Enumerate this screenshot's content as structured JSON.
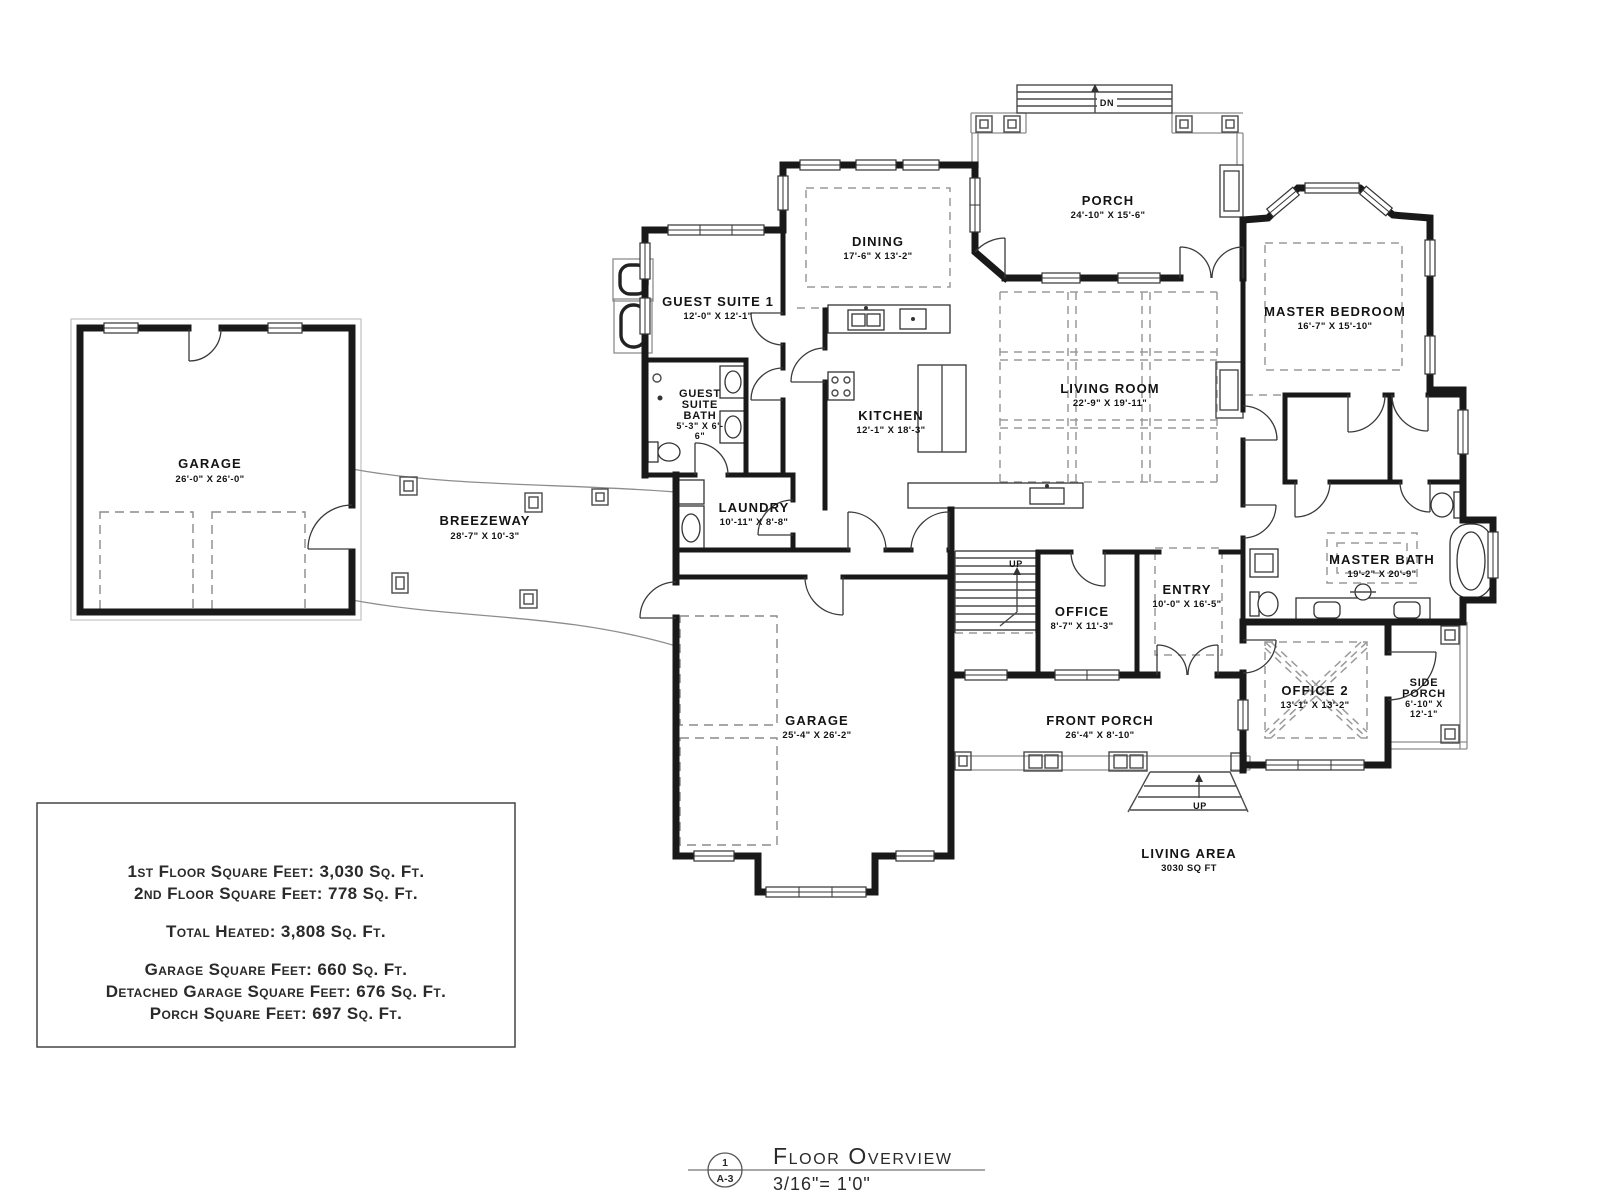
{
  "rooms": {
    "detached_garage": {
      "name": "GARAGE",
      "dims": "26'-0\" X 26'-0\""
    },
    "breezeway": {
      "name": "BREEZEWAY",
      "dims": "28'-7\" X 10'-3\""
    },
    "guest_suite_1": {
      "name": "GUEST SUITE 1",
      "dims": "12'-0\" X 12'-1\""
    },
    "guest_suite_bath": {
      "lines": [
        "GUEST",
        "SUITE",
        "BATH",
        "5'-3\" X 6'-",
        "6\""
      ]
    },
    "dining": {
      "name": "DINING",
      "dims": "17'-6\" X 13'-2\""
    },
    "rear_porch": {
      "name": "PORCH",
      "dims": "24'-10\" X 15'-6\""
    },
    "master_bedroom": {
      "name": "MASTER BEDROOM",
      "dims": "16'-7\" X 15'-10\""
    },
    "living_room": {
      "name": "LIVING ROOM",
      "dims": "22'-9\" X 19'-11\""
    },
    "kitchen": {
      "name": "KITCHEN",
      "dims": "12'-1\" X 18'-3\""
    },
    "laundry": {
      "name": "LAUNDRY",
      "dims": "10'-11\" X 8'-8\""
    },
    "master_bath": {
      "name": "MASTER BATH",
      "dims": "19'-2\" X 20'-9\""
    },
    "office": {
      "name": "OFFICE",
      "dims": "8'-7\" X 11'-3\""
    },
    "entry": {
      "name": "ENTRY",
      "dims": "10'-0\" X 16'-5\""
    },
    "office_2": {
      "name": "OFFICE 2",
      "dims": "13'-1\" X 13'-2\""
    },
    "side_porch": {
      "lines": [
        "SIDE",
        "PORCH",
        "6'-10\" X",
        "12'-1\""
      ]
    },
    "garage": {
      "name": "GARAGE",
      "dims": "25'-4\" X 26'-2\""
    },
    "front_porch": {
      "name": "FRONT PORCH",
      "dims": "26'-4\" X 8'-10\""
    }
  },
  "annotations": {
    "living_area_line1": "LIVING AREA",
    "living_area_line2": "3030 SQ FT",
    "stairs_up": "UP",
    "front_steps_up": "UP",
    "rear_steps_down": "DN"
  },
  "summary_box": {
    "line1": "1st Floor Square Feet: 3,030 Sq. Ft.",
    "line2": "2nd Floor Square Feet: 778 Sq. Ft.",
    "line3": "Total Heated: 3,808 Sq. Ft.",
    "line4": "Garage Square Feet: 660 Sq. Ft.",
    "line5": "Detached Garage Square Feet: 676 Sq. Ft.",
    "line6": "Porch Square Feet: 697 Sq. Ft."
  },
  "title_block": {
    "detail_number": "1",
    "sheet_number": "A-3",
    "title": "Floor Overview",
    "scale": "3/16\"= 1'0\""
  },
  "colors": {
    "wall": "#191919",
    "thin_line": "#4a4a4a",
    "dashed_line": "#9a9a9a",
    "text": "#141414",
    "paper": "#ffffff"
  }
}
